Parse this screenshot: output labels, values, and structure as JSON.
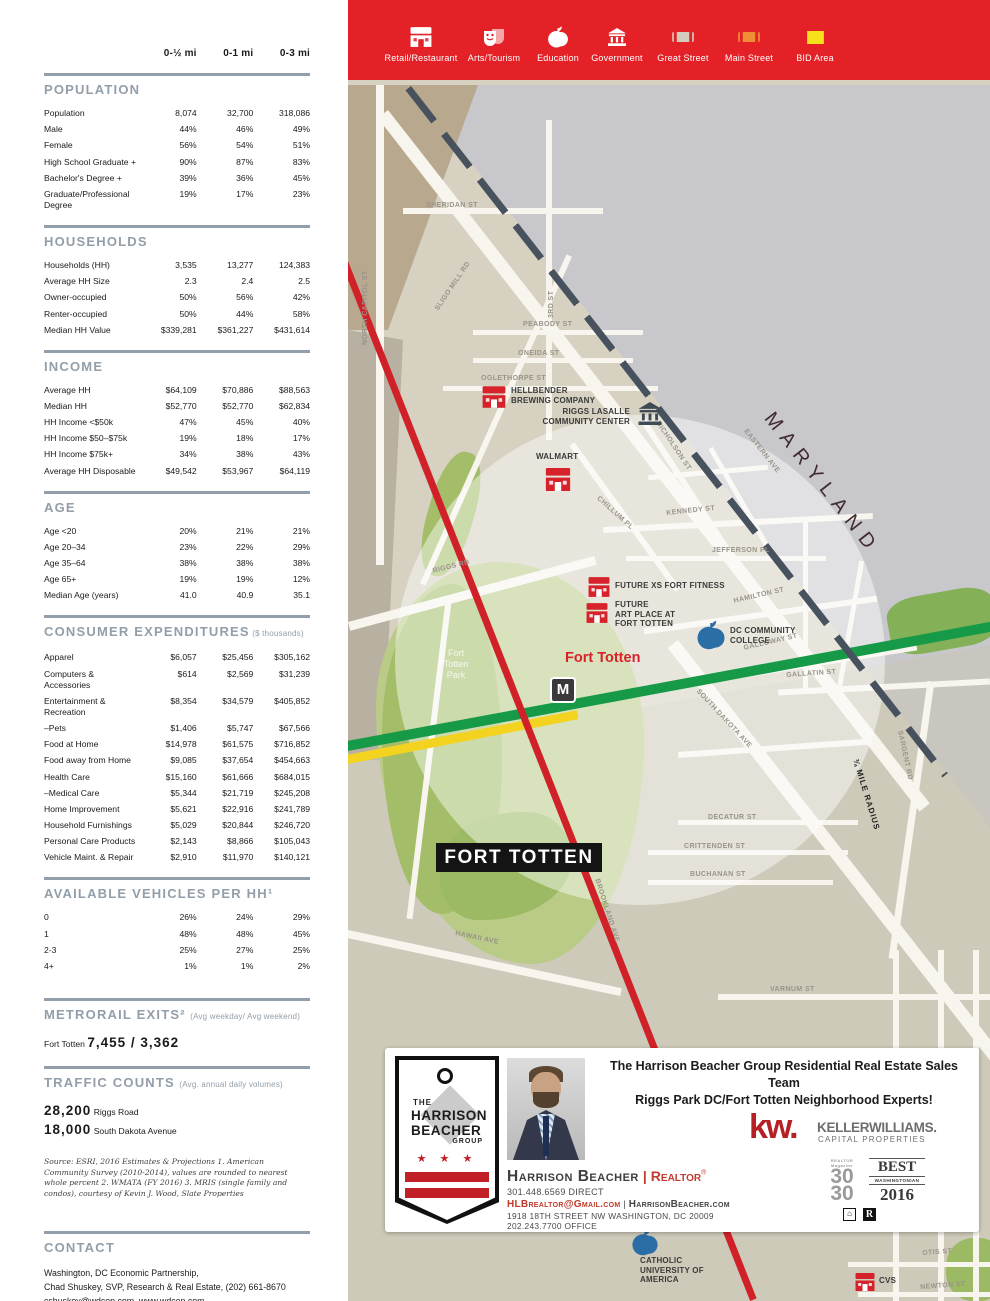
{
  "columns": [
    "0-½ mi",
    "0-1 mi",
    "0-3 mi"
  ],
  "sections": [
    {
      "title": "POPULATION",
      "note": "",
      "rows": [
        {
          "label": "Population",
          "values": [
            "8,074",
            "32,700",
            "318,086"
          ]
        },
        {
          "label": "Male",
          "values": [
            "44%",
            "46%",
            "49%"
          ]
        },
        {
          "label": "Female",
          "values": [
            "56%",
            "54%",
            "51%"
          ]
        },
        {
          "label": "High School Graduate +",
          "values": [
            "90%",
            "87%",
            "83%"
          ]
        },
        {
          "label": "Bachelor's Degree +",
          "values": [
            "39%",
            "36%",
            "45%"
          ]
        },
        {
          "label": "Graduate/Professional Degree",
          "values": [
            "19%",
            "17%",
            "23%"
          ]
        }
      ]
    },
    {
      "title": "HOUSEHOLDS",
      "note": "",
      "rows": [
        {
          "label": "Households (HH)",
          "values": [
            "3,535",
            "13,277",
            "124,383"
          ]
        },
        {
          "label": "Average HH Size",
          "values": [
            "2.3",
            "2.4",
            "2.5"
          ]
        },
        {
          "label": "Owner-occupied",
          "values": [
            "50%",
            "56%",
            "42%"
          ]
        },
        {
          "label": "Renter-occupied",
          "values": [
            "50%",
            "44%",
            "58%"
          ]
        },
        {
          "label": "Median HH Value",
          "values": [
            "$339,281",
            "$361,227",
            "$431,614"
          ]
        }
      ]
    },
    {
      "title": "INCOME",
      "note": "",
      "rows": [
        {
          "label": "Average HH",
          "values": [
            "$64,109",
            "$70,886",
            "$88,563"
          ]
        },
        {
          "label": "Median HH",
          "values": [
            "$52,770",
            "$52,770",
            "$62,834"
          ]
        },
        {
          "label": "HH Income <$50k",
          "values": [
            "47%",
            "45%",
            "40%"
          ]
        },
        {
          "label": "HH Income $50–$75k",
          "values": [
            "19%",
            "18%",
            "17%"
          ]
        },
        {
          "label": "HH Income $75k+",
          "values": [
            "34%",
            "38%",
            "43%"
          ]
        },
        {
          "label": "Average HH Disposable",
          "values": [
            "$49,542",
            "$53,967",
            "$64,119"
          ]
        }
      ]
    },
    {
      "title": "AGE",
      "note": "",
      "rows": [
        {
          "label": "Age <20",
          "values": [
            "20%",
            "21%",
            "21%"
          ]
        },
        {
          "label": "Age 20–34",
          "values": [
            "23%",
            "22%",
            "29%"
          ]
        },
        {
          "label": "Age 35–64",
          "values": [
            "38%",
            "38%",
            "38%"
          ]
        },
        {
          "label": "Age 65+",
          "values": [
            "19%",
            "19%",
            "12%"
          ]
        },
        {
          "label": "Median Age (years)",
          "values": [
            "41.0",
            "40.9",
            "35.1"
          ]
        }
      ]
    },
    {
      "title": "CONSUMER EXPENDITURES",
      "note": "($ thousands)",
      "rows": [
        {
          "label": "Apparel",
          "values": [
            "$6,057",
            "$25,456",
            "$305,162"
          ]
        },
        {
          "label": "Computers & Accessories",
          "values": [
            "$614",
            "$2,569",
            "$31,239"
          ]
        },
        {
          "label": "Entertainment & Recreation",
          "values": [
            "$8,354",
            "$34,579",
            "$405,852"
          ]
        },
        {
          "label": "–Pets",
          "values": [
            "$1,406",
            "$5,747",
            "$67,566"
          ]
        },
        {
          "label": "Food at Home",
          "values": [
            "$14,978",
            "$61,575",
            "$716,852"
          ]
        },
        {
          "label": "Food away from Home",
          "values": [
            "$9,085",
            "$37,654",
            "$454,663"
          ]
        },
        {
          "label": "Health Care",
          "values": [
            "$15,160",
            "$61,666",
            "$684,015"
          ]
        },
        {
          "label": "–Medical Care",
          "values": [
            "$5,344",
            "$21,719",
            "$245,208"
          ]
        },
        {
          "label": "Home Improvement",
          "values": [
            "$5,621",
            "$22,916",
            "$241,789"
          ]
        },
        {
          "label": "Household Furnishings",
          "values": [
            "$5,029",
            "$20,844",
            "$246,720"
          ]
        },
        {
          "label": "Personal Care Products",
          "values": [
            "$2,143",
            "$8,866",
            "$105,043"
          ]
        },
        {
          "label": "Vehicle Maint. & Repair",
          "values": [
            "$2,910",
            "$11,970",
            "$140,121"
          ]
        }
      ]
    },
    {
      "title": "AVAILABLE VEHICLES PER HH¹",
      "note": "",
      "rows": [
        {
          "label": "0",
          "values": [
            "26%",
            "24%",
            "29%"
          ]
        },
        {
          "label": "1",
          "values": [
            "48%",
            "48%",
            "45%"
          ]
        },
        {
          "label": "2-3",
          "values": [
            "25%",
            "27%",
            "25%"
          ]
        },
        {
          "label": "4+",
          "values": [
            "1%",
            "1%",
            "2%"
          ]
        }
      ]
    }
  ],
  "metrorail": {
    "title": "METRORAIL EXITS²",
    "note": "(Avg weekday/ Avg weekend)",
    "station": "Fort Totten",
    "value": "7,455 / 3,362"
  },
  "traffic": {
    "title": "TRAFFIC COUNTS",
    "note": "(Avg. annual daily volumes)",
    "rows": [
      {
        "value": "28,200",
        "label": "Riggs Road"
      },
      {
        "value": "18,000",
        "label": "South Dakota Avenue"
      }
    ]
  },
  "source_note": "Source: ESRI, 2016 Estimates & Projections 1. American Community Survey (2010-2014), values are rounded to nearest whole percent 2. WMATA (FY 2016)  3. MRIS (single family and condos), courtesy of Kevin J. Wood, Slate Properties",
  "contact": {
    "title": "CONTACT",
    "lines": [
      "Washington, DC Economic Partnership,",
      "Chad Shuskey, SVP, Research & Real Estate, (202) 661-8670",
      "cshuskey@wdcep.com, www.wdcep.com"
    ]
  },
  "legend": {
    "items": [
      {
        "type": "retail",
        "label": "Retail/Restaurant"
      },
      {
        "type": "arts",
        "label": "Arts/Tourism"
      },
      {
        "type": "education",
        "label": "Education"
      },
      {
        "type": "government",
        "label": "Government"
      },
      {
        "type": "great-street",
        "label": "Great Street"
      },
      {
        "type": "main-street",
        "label": "Main Street"
      },
      {
        "type": "bid-area",
        "label": "BID Area"
      }
    ]
  },
  "map": {
    "maryland": "MARYLAND",
    "radius_label": "¾ MILE RADIUS",
    "park_label": "Fort\nTotten\nPark",
    "area_label": "FORT TOTTEN",
    "station_label": "Fort Totten",
    "station_m": "M",
    "streets": [
      "SHERIDAN ST",
      "PEABODY ST",
      "ONEIDA ST",
      "OGLETHORPE ST",
      "NORTH CAPITOL ST",
      "SLIGO MILL RD",
      "3RD ST",
      "RIGGS RD",
      "NICHOLSON ST",
      "CHILLUM PL",
      "KENNEDY ST",
      "JEFFERSON PL",
      "HAMILTON ST",
      "GALLOWAY ST",
      "GALLATIN ST",
      "SOUTH DAKOTA AVE",
      "SARGENT RD",
      "DECATUR ST",
      "CRITTENDEN ST",
      "BUCHANAN ST",
      "VARNUM ST",
      "HAWAII AVE",
      "BROOKLAND AVE",
      "EASTERN AVE",
      "OTIS ST",
      "NEWTON ST",
      "10TH ST"
    ],
    "pois": [
      {
        "type": "retail",
        "label": "HELLBENDER\nBREWING COMPANY"
      },
      {
        "type": "government",
        "label": "RIGGS LASALLE\nCOMMUNITY CENTER"
      },
      {
        "type": "retail",
        "label": "WALMART"
      },
      {
        "type": "retail",
        "label": "FUTURE XS FORT FITNESS"
      },
      {
        "type": "retail",
        "label": "FUTURE\nART PLACE AT\nFORT TOTTEN"
      },
      {
        "type": "education",
        "label": "DC COMMUNITY\nCOLLEGE"
      },
      {
        "type": "education",
        "label": "CATHOLIC\nUNIVERSITY OF\nAMERICA"
      },
      {
        "type": "retail",
        "label": "CVS"
      }
    ]
  },
  "card": {
    "headline_line1": "The Harrison Beacher Group Residential Real Estate Sales Team",
    "headline_line2": "Riggs Park DC/Fort Totten Neighborhood Experts!",
    "logo": {
      "the": "THE",
      "name1": "HARRISON",
      "name2": "BEACHER",
      "group": "GROUP",
      "stars": "★ ★ ★"
    },
    "agent_name": "Harrison Beacher",
    "divider": "|",
    "agent_title": "Realtor",
    "reg": "®",
    "phone_direct": "301.448.6569 DIRECT",
    "email": "HLBrealtor@Gmail.com",
    "separator": " | ",
    "website": "HarrisonBeacher.com",
    "address": "1918 18TH STREET NW WASHINGTON, DC 20009",
    "phone_office": "202.243.7700 OFFICE",
    "kw_logo": "kw.",
    "kw_name": "KELLERWILLIAMS.",
    "kw_sub": "CAPITAL PROPERTIES",
    "badge_30_small": "REALTOR Magazine",
    "badge_30_top": "30",
    "badge_30_bottom": "30",
    "best_title": "BEST",
    "best_mid": "WASHINGTONIAN",
    "best_year": "2016",
    "eq_glyph": "⌂",
    "rr_glyph": "R"
  }
}
